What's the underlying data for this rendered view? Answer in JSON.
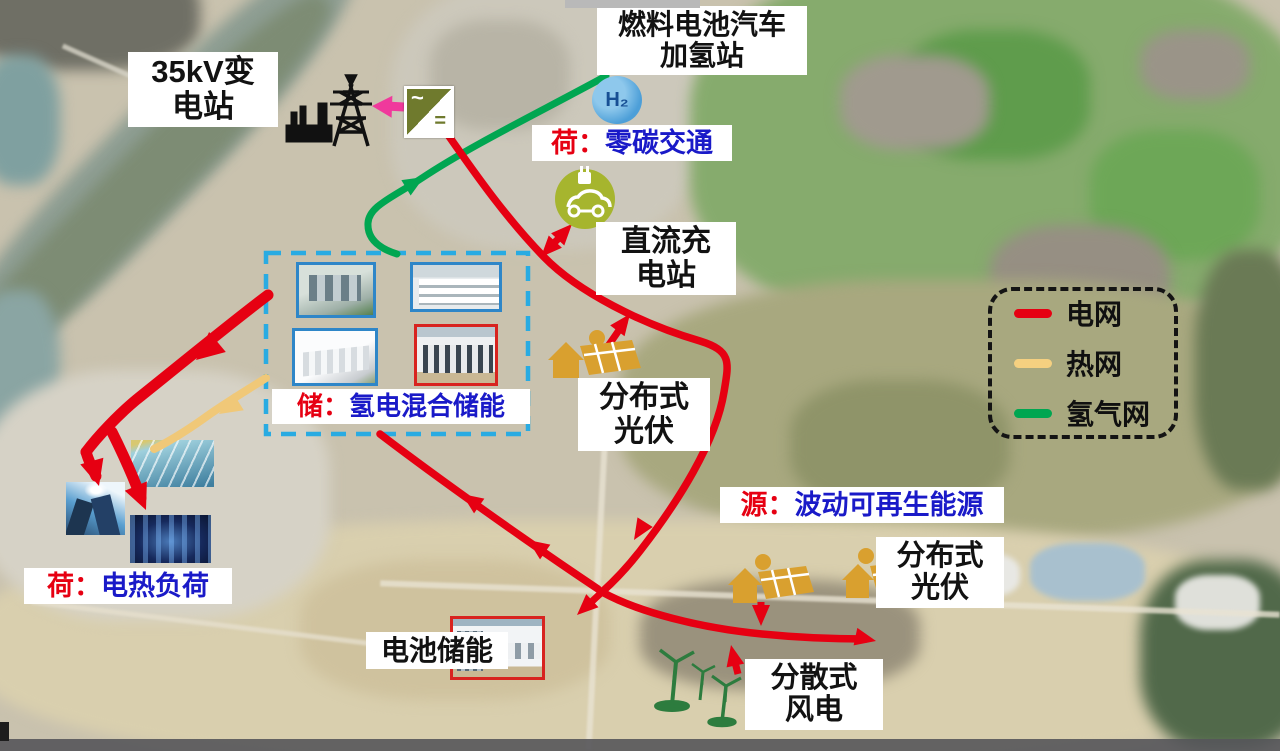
{
  "annotations": {
    "substation": {
      "line1": "35kV变",
      "line2": "电站"
    },
    "fuel_station": {
      "line1": "燃料电池汽车",
      "line2": "加氢站"
    },
    "hydrogen_icon_text": "H₂",
    "load_transport": {
      "prefix": "荷：",
      "text": "零碳交通"
    },
    "dc_charging": {
      "line1": "直流充",
      "line2": "电站"
    },
    "pv_distributed_1": {
      "line1": "分布式",
      "line2": "光伏"
    },
    "storage": {
      "prefix": "储：",
      "text": "氢电混合储能"
    },
    "source": {
      "prefix": "源：",
      "text": "波动可再生能源"
    },
    "pv_distributed_2": {
      "line1": "分布式",
      "line2": "光伏"
    },
    "battery_storage": "电池储能",
    "wind": {
      "line1": "分散式",
      "line2": "风电"
    },
    "heat_load": {
      "prefix": "荷：",
      "text": "电热负荷"
    }
  },
  "inverter": {
    "ac_symbol": "~",
    "dc_symbol": "="
  },
  "legend": {
    "items": [
      {
        "label": "电网",
        "color": "#e60012"
      },
      {
        "label": "热网",
        "color": "#f5d080"
      },
      {
        "label": "氢气网",
        "color": "#00a651"
      }
    ]
  },
  "colors": {
    "grid_line": "#e60012",
    "heat_line": "#f0c878",
    "hydrogen_line": "#00a651",
    "label_red": "#e60012",
    "label_blue": "#1a1ac8",
    "storage_box_border": "#29abe2",
    "pink_arrow": "#f0399c"
  }
}
